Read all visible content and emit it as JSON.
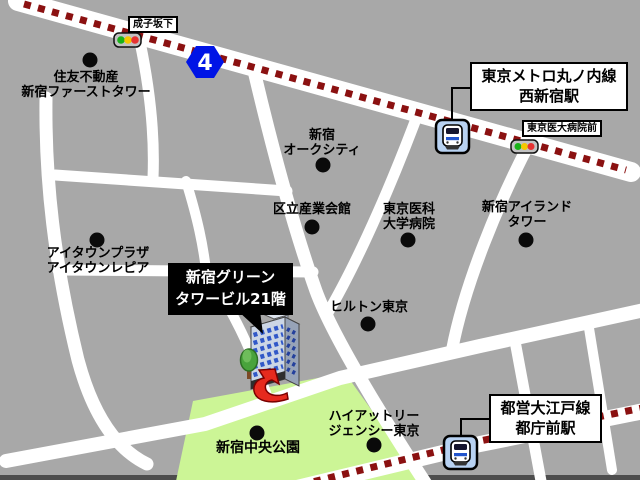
{
  "map": {
    "route_badge": "4",
    "signals": {
      "narukozaka": "成子坂下",
      "tokyo_idai_byoin_mae": "東京医大病院前"
    },
    "stations": [
      {
        "name": "東京メトロ丸ノ内線\n西新宿駅"
      },
      {
        "name": "都営大江戸線\n都庁前駅"
      }
    ],
    "destination": {
      "label": "新宿グリーン\nタワービル21階"
    },
    "landmarks": [
      {
        "label": "住友不動産\n新宿ファーストタワー"
      },
      {
        "label": "新宿\nオークシティ"
      },
      {
        "label": "区立産業会館"
      },
      {
        "label": "東京医科\n大学病院"
      },
      {
        "label": "新宿アイランド\nタワー"
      },
      {
        "label": "アイタウンプラザ\nアイタウンレピア"
      },
      {
        "label": "ヒルトン東京"
      },
      {
        "label": "ハイアットリー\nジェンシー東京"
      },
      {
        "label": "新宿中央公園"
      }
    ],
    "colors": {
      "background": "#a8a8a8",
      "road": "#ffffff",
      "rail_dash": "#8b1111",
      "park": "#ccf596",
      "route_badge_bg": "#0014e6",
      "station_icon_bg": "#b8d2f2",
      "destination_box_bg": "#000000",
      "traffic_light_green": "#19b219",
      "traffic_light_yellow": "#f5c800",
      "traffic_light_red": "#e63232"
    }
  }
}
